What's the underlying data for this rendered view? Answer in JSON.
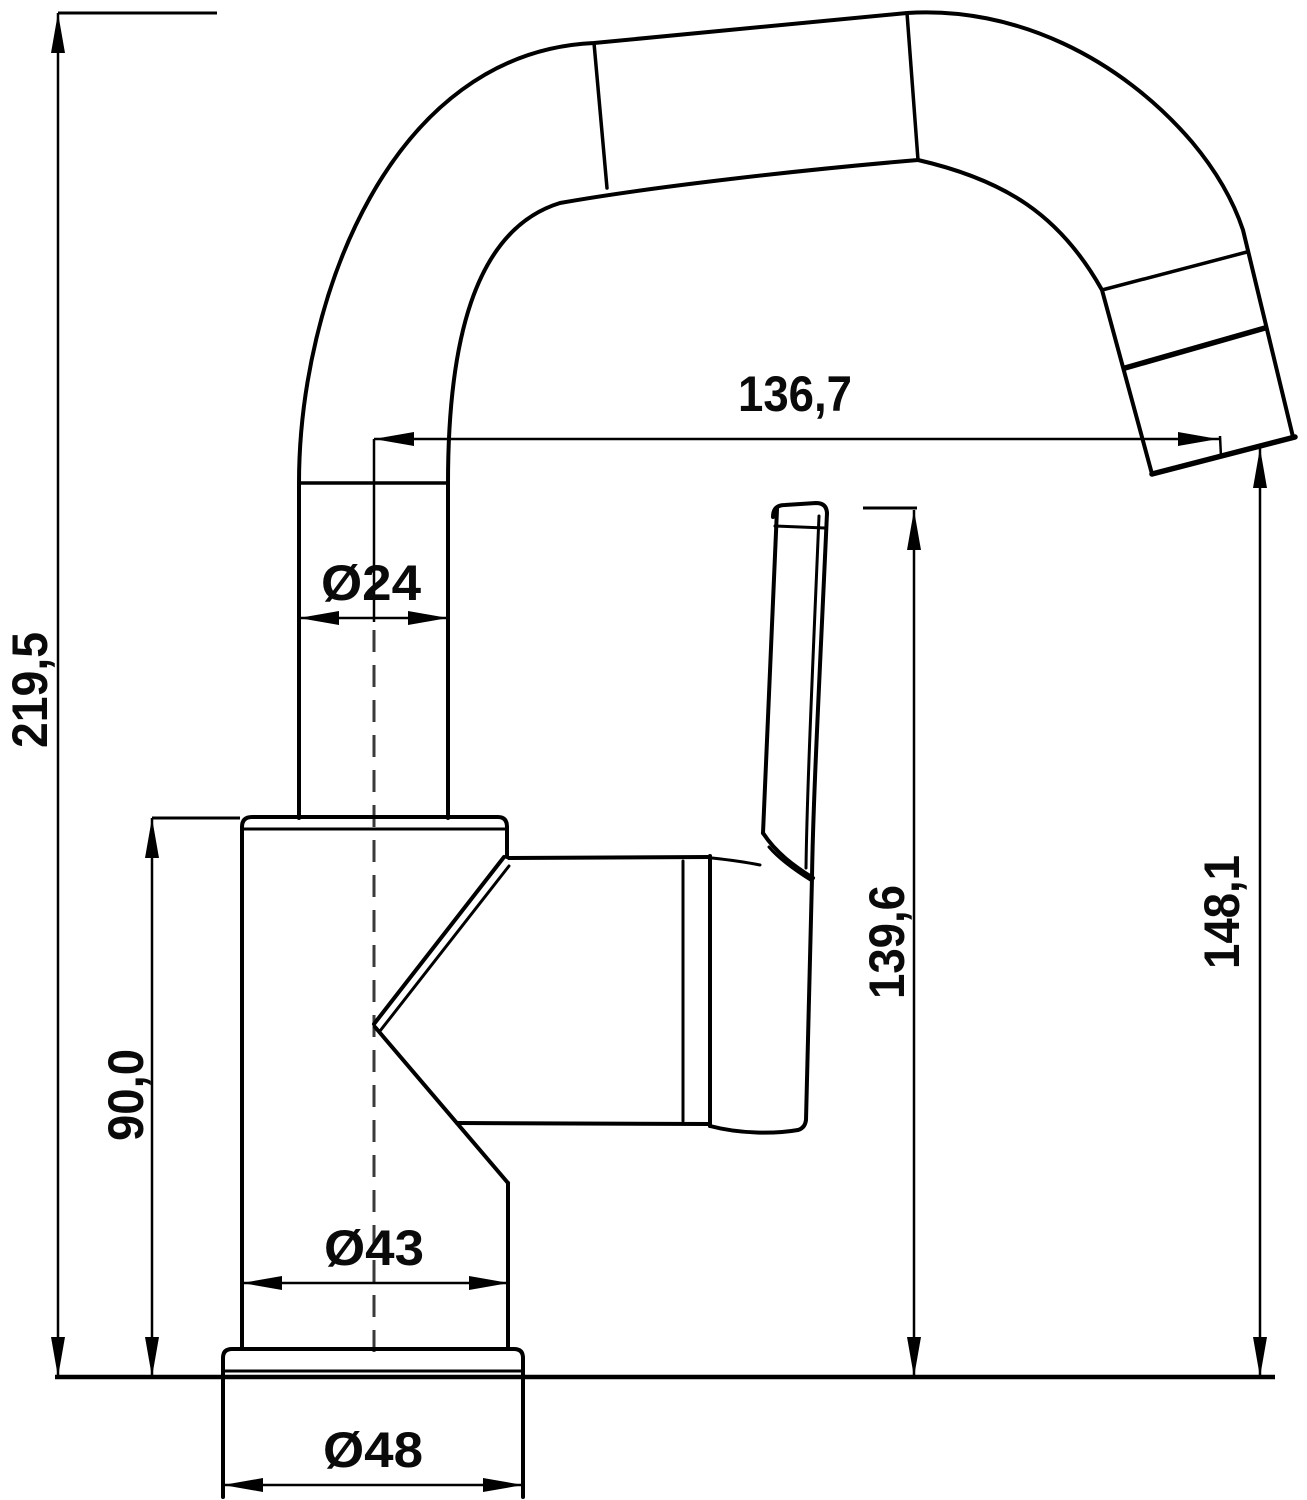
{
  "drawing": {
    "description": "faucet-side-view-technical-drawing",
    "colors": {
      "line": "#000000",
      "background": "#ffffff",
      "centerline": "#3a3a3a"
    },
    "dimensions": {
      "overall_height": "219,5",
      "body_height": "90,0",
      "spout_reach": "136,7",
      "spout_pipe_diameter": "Ø24",
      "handle_top_height": "139,6",
      "outlet_height": "148,1",
      "body_diameter": "Ø43",
      "base_diameter": "Ø48"
    }
  }
}
